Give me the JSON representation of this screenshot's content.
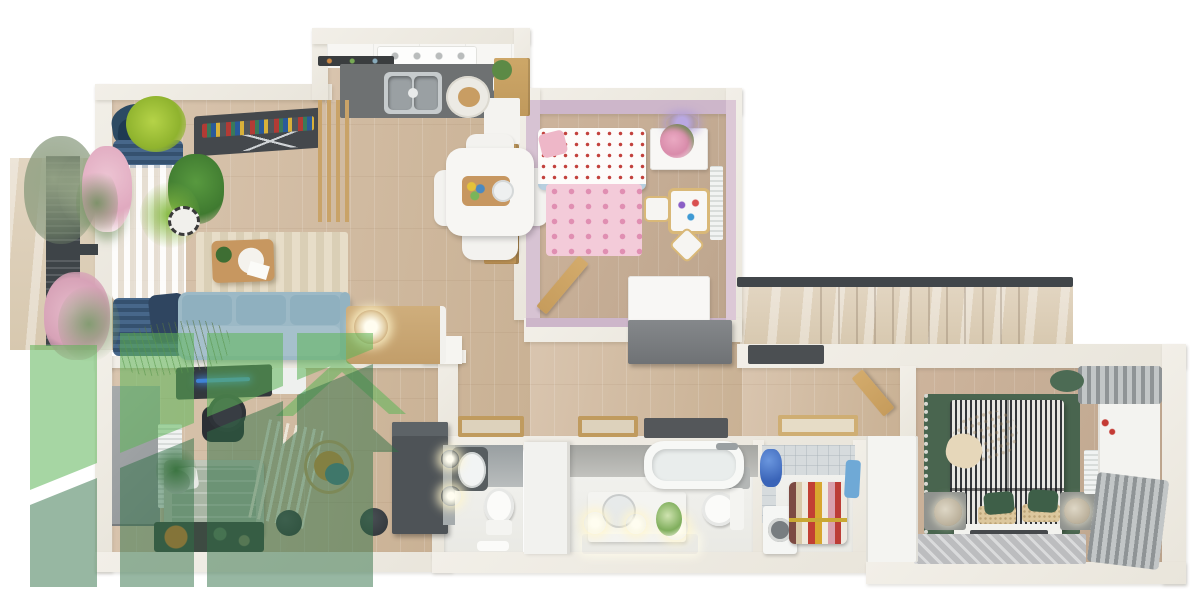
{
  "scene": {
    "description": "Photorealistic top-down 3D render of an apartment floor plan with a translucent green logo watermark in the lower-left corner",
    "background_color": "#ffffff"
  },
  "palette": {
    "bg": "#ffffff",
    "wall": "#e9e5db",
    "wood_floor": "#d2bda6",
    "wood_floor_dark": "#c6ae96",
    "travertine": "#dccfba",
    "kids_wall_pink": "#d2bccf",
    "kids_rug_pink": "#f3cbd9",
    "kids_heart_pink": "#e08fb2",
    "sofa_blue": "#9cb9c6",
    "curtain_navy": "#42628a",
    "kitchen_counter_gray": "#6e7172",
    "bedroom_rug_green": "#49654f",
    "bed_stripe_dark": "#33363a",
    "plant_green": "#5c8a46",
    "accent_orange": "#d6913f",
    "tile_gray": "#d6dbdd",
    "dark_furniture": "#4e5357",
    "watermark_light_green": "#5db458",
    "watermark_sage_green": "#2f6f45"
  },
  "watermark": {
    "style": "four translucent vertical bars cut by a white diagonal swoosh, with a roof chevron and gable forming a house silhouette",
    "light_color": "#5db458",
    "sage_color": "#2f6f45"
  },
  "rooms": [
    {
      "id": "balcony",
      "name": "balcony",
      "furniture": [
        "slatted privacy screen",
        "olive tree",
        "flowering plants",
        "stone floor"
      ]
    },
    {
      "id": "living-room",
      "name": "living room",
      "furniture": [
        "blue blackout curtains",
        "sheer curtains",
        "wall shelf with books",
        "potted plants",
        "striped rug",
        "wooden coffee table",
        "light blue sofa",
        "console with ball lamp"
      ]
    },
    {
      "id": "kitchen",
      "name": "kitchen",
      "furniture": [
        "white upper cabinets",
        "cooktop",
        "dark countertop",
        "double sink",
        "round serving board",
        "tall wooden cabinet",
        "white appliance"
      ]
    },
    {
      "id": "dining-area",
      "name": "dining area",
      "furniture": [
        "white dining table",
        "four white chairs",
        "wood slat partition"
      ]
    },
    {
      "id": "kids-bedroom",
      "name": "kids bedroom",
      "furniture": [
        "single bed with dotted duvet",
        "pink heart rug",
        "white dresser with flowers",
        "play table with stools",
        "radiator",
        "purple ceiling lamp",
        "white storage",
        "open wooden door"
      ]
    },
    {
      "id": "hallway",
      "name": "hallway",
      "furniture": [
        "gray storage cabinet",
        "wooden doormats",
        "dark doormat"
      ]
    },
    {
      "id": "home-office",
      "name": "home office / second bedroom",
      "furniture": [
        "dark desk",
        "gaming chair",
        "gray wardrobe",
        "radiator",
        "single bed",
        "tall grass plant",
        "dark rug with orange accent",
        "slatted room divider",
        "hanging rattan chair",
        "sphere floor lamps",
        "dark wardrobe"
      ]
    },
    {
      "id": "wc",
      "name": "wc",
      "furniture": [
        "backlit mirror",
        "washbasin",
        "toilet",
        "white mat"
      ]
    },
    {
      "id": "bathroom",
      "name": "bathroom",
      "furniture": [
        "bathtub",
        "vanity with round mirror",
        "glowing sconce lights",
        "flowers",
        "toilet",
        "ribbed bath mat",
        "white door"
      ]
    },
    {
      "id": "laundry-room",
      "name": "laundry room",
      "furniture": [
        "tiled walls",
        "blue laundry basin",
        "washing machine",
        "drying rack with colorful clothes",
        "blue towel"
      ]
    },
    {
      "id": "master-bedroom",
      "name": "master bedroom",
      "furniture": [
        "green rug with fringe",
        "double bed with striped bedding",
        "chunky knit throw",
        "green pillows",
        "nightstands with round lamps",
        "bench",
        "gray rug",
        "radiator",
        "geranium plant",
        "white console",
        "gray curtains",
        "green pouf",
        "white wardrobe",
        "open wooden door"
      ]
    },
    {
      "id": "staircase",
      "name": "staircase",
      "furniture": [
        "travertine steps",
        "dark handrail",
        "dark doormat"
      ]
    }
  ]
}
